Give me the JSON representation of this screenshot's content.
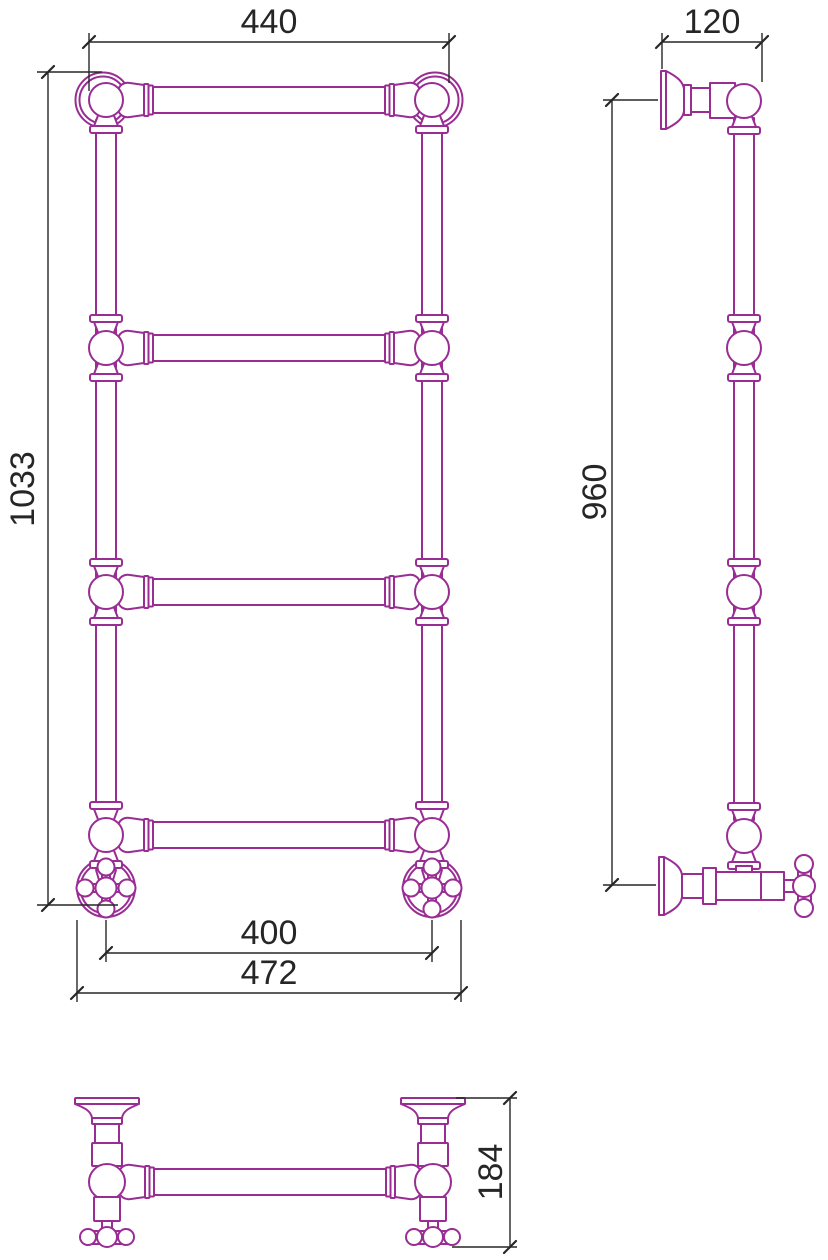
{
  "drawing": {
    "dimensions": {
      "front_top_width": "440",
      "front_height": "1033",
      "bottom_pipe_spacing": "400",
      "bottom_overall_width": "472",
      "side_top_depth": "120",
      "side_mount_height": "960",
      "plan_depth": "184"
    }
  },
  "colors": {
    "outline": "#992d94",
    "dim": "#262626",
    "bg": "#ffffff"
  }
}
